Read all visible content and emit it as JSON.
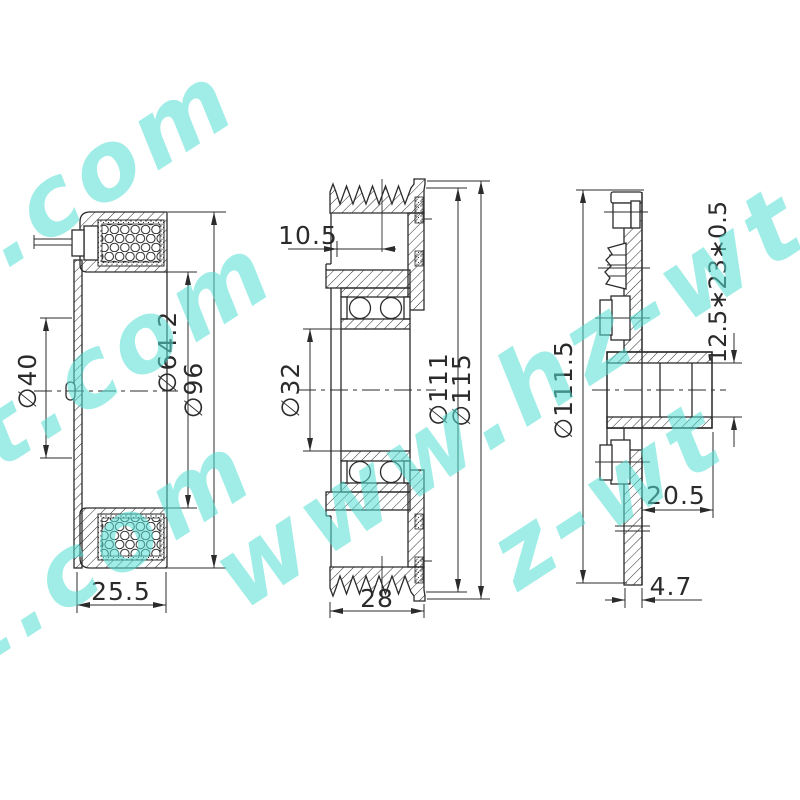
{
  "title": "compressor-clutch-technical-drawing",
  "watermark": {
    "text": "www.hz-wt.com",
    "color": "#54dfd4",
    "fragments": [
      "t.com",
      "t.com",
      "www.hz-wt.com",
      "z-wt",
      "t.com"
    ]
  },
  "line_color": "#2b2b2b",
  "dims": {
    "left": {
      "bore": "∅40",
      "coil": "∅64.2",
      "outer": "∅96",
      "width": "25.5"
    },
    "middle": {
      "offset": "10.5",
      "bore": "∅32",
      "friction": "∅111",
      "outer": "∅115",
      "width": "28"
    },
    "right": {
      "outer": "∅111.5",
      "spline": "12.5∗23∗0.5",
      "hub": "20.5",
      "plate": "4.7"
    }
  }
}
